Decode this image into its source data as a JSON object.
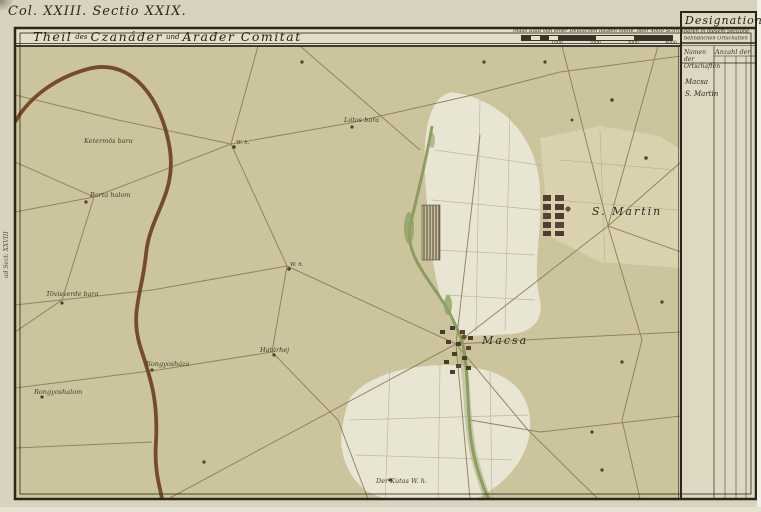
{
  "header": {
    "sheet_ref": "Col. XXIII. Sectio XXIX.",
    "title": {
      "t1": "Theil",
      "c1": "des",
      "t2": "Czanáder",
      "c2": "und",
      "t3": "Arader Comitat"
    }
  },
  "scalebar": {
    "caption": "Maas Stab von einer Deutschen halben Meile, oder 4000 Schritt",
    "ticks": [
      "1000",
      "2000",
      "3000",
      "4000"
    ]
  },
  "legend_panel": {
    "title": "Designation",
    "subtitle1": "deren in diesem Sectione",
    "subtitle2": "befindlichen Ortschaften",
    "col_names": "Namen der Ortschaften",
    "col_counts": "Anzahl der",
    "rows": [
      {
        "name": "Macsa"
      },
      {
        "name": "S. Martin"
      }
    ]
  },
  "map": {
    "labels": [
      {
        "text": "Lótos bara",
        "x": 344,
        "y": 116,
        "cls": "sm"
      },
      {
        "text": "Ketermös bara",
        "x": 84,
        "y": 137,
        "cls": "sm"
      },
      {
        "text": "Barta halom",
        "x": 90,
        "y": 191,
        "cls": "sm"
      },
      {
        "text": "Tövisverde bara",
        "x": 46,
        "y": 290,
        "cls": "sm"
      },
      {
        "text": "W. h.",
        "x": 236,
        "y": 140,
        "cls": "tiny"
      },
      {
        "text": "W. h.",
        "x": 290,
        "y": 262,
        "cls": "tiny"
      },
      {
        "text": "Határhej",
        "x": 260,
        "y": 346,
        "cls": "sm"
      },
      {
        "text": "Rongyosháza",
        "x": 146,
        "y": 360,
        "cls": "sm"
      },
      {
        "text": "Rongyoshalom",
        "x": 34,
        "y": 388,
        "cls": "sm"
      },
      {
        "text": "S. Martin",
        "x": 592,
        "y": 205,
        "cls": "lg"
      },
      {
        "text": "Macsa",
        "x": 482,
        "y": 334,
        "cls": "lg"
      },
      {
        "text": "Der Kutas W. h.",
        "x": 376,
        "y": 477,
        "cls": "sm"
      },
      {
        "text": "ad Sect: XXVIII",
        "x": 3,
        "y": 278,
        "cls": "vert"
      }
    ]
  },
  "palette": {
    "paper": "#d8d2be",
    "map_fill": "#ccc49d",
    "field_white": "#e9e5d3",
    "panel_bg": "#ded8c3",
    "border_ink": "#2b251c",
    "road_major": "#6f4023",
    "road_minor": "#8d7c57",
    "creek_green": "#87975a",
    "text_ink": "#3a3224"
  }
}
